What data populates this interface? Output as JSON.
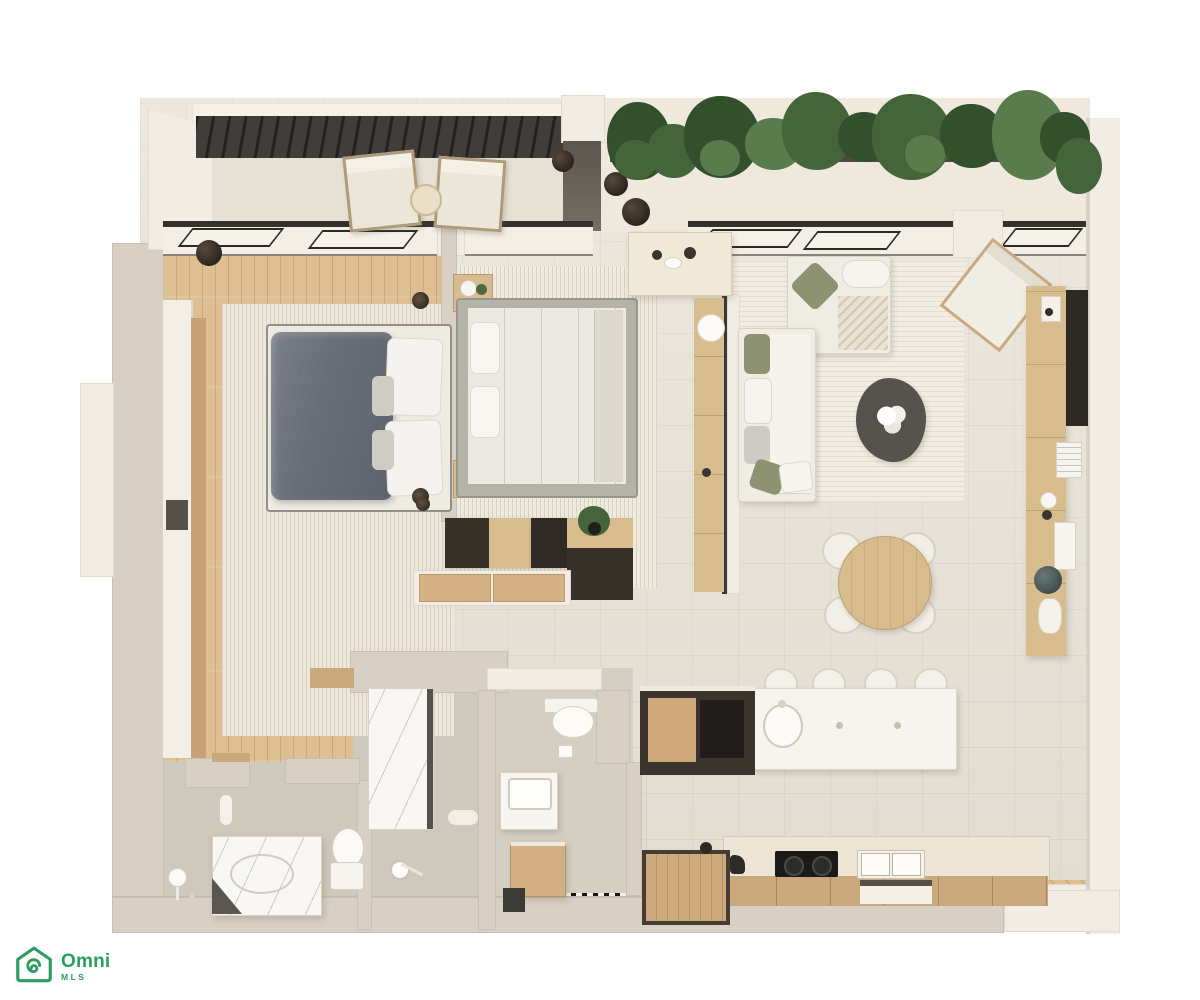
{
  "palette": {
    "bg": "#ffffff",
    "wall": "#d8cfc5",
    "wallLight": "#f2ede4",
    "floor": "#e8e2d6",
    "wood": "#ddbf93",
    "bathFloor": "#cfc8bc",
    "rug": "#ece7da",
    "olive": "#8d9271",
    "slate": "#6e727b",
    "woodFurn": "#d9bc8e",
    "darkFurn": "#37312a",
    "marble": "#f8f7f4",
    "plantDark": "#33502d",
    "plantMid": "#44653a",
    "plantLight": "#5a7c4c",
    "brand": "#2a9d5f"
  },
  "logo": {
    "brand": "Omni",
    "sub": "MLS"
  },
  "plan": {
    "kind": "3d-floor-plan-render",
    "rooms": [
      {
        "name": "balcony-with-lounge-chairs"
      },
      {
        "name": "terrace-with-planter-hedge"
      },
      {
        "name": "bedroom-1-master"
      },
      {
        "name": "bedroom-2"
      },
      {
        "name": "living-room"
      },
      {
        "name": "dining-area"
      },
      {
        "name": "kitchen"
      },
      {
        "name": "bathroom-1-master"
      },
      {
        "name": "bathroom-2"
      },
      {
        "name": "entry-hall"
      }
    ],
    "furniture": [
      "lounge-chair",
      "side-table",
      "double-bed-dark-duvet",
      "double-bed-light",
      "nightstand",
      "wardrobe",
      "dresser-storage",
      "l-shaped-sofa",
      "coffee-table",
      "accent-chair",
      "media-console-tv",
      "round-dining-table",
      "dining-chair",
      "kitchen-island-with-sink",
      "bar-stool",
      "cooktop",
      "double-sink",
      "tall-cabinet",
      "toilet",
      "vanity-basin",
      "marble-tub",
      "shower",
      "planter-pots"
    ]
  }
}
